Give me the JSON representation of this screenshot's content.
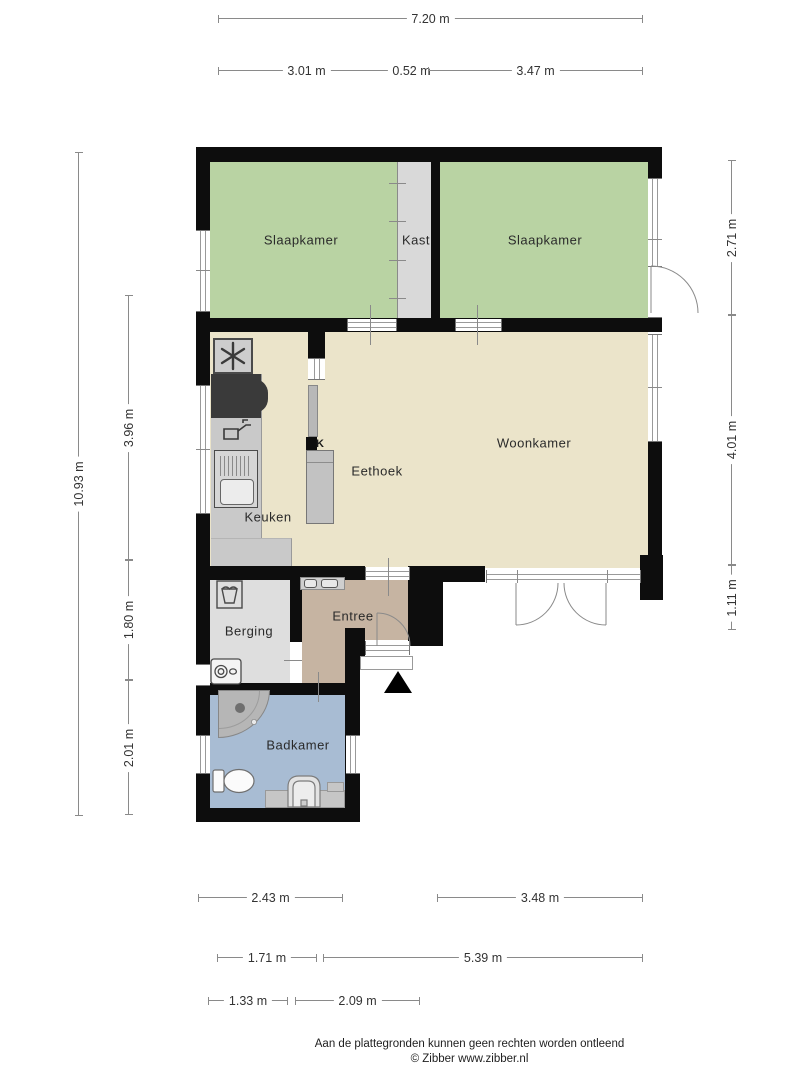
{
  "rooms": {
    "slaapkamer_left": "Slaapkamer",
    "kast": "Kast",
    "slaapkamer_right": "Slaapkamer",
    "woonkamer": "Woonkamer",
    "eethoek": "Eethoek",
    "keuken": "Keuken",
    "kast_small": "K",
    "berging": "Berging",
    "entree": "Entree",
    "badkamer": "Badkamer"
  },
  "dimensions": {
    "top_total": "7.20 m",
    "top_segments": [
      "3.01 m",
      "0.52 m",
      "3.47 m"
    ],
    "left_total": "10.93 m",
    "left_segments": [
      "3.96 m",
      "1.80 m",
      "2.01 m"
    ],
    "right_segments": [
      "2.71 m",
      "4.01 m",
      "1.11 m"
    ],
    "bottom_row1": [
      "2.43 m",
      "3.48 m"
    ],
    "bottom_row2": [
      "1.71 m",
      "5.39 m"
    ],
    "bottom_row3": [
      "1.33 m",
      "2.09 m"
    ]
  },
  "footer": {
    "disclaimer": "Aan de plattegronden kunnen geen rechten worden ontleend",
    "copyright": "© Zibber www.zibber.nl"
  },
  "colors": {
    "wall": "#0d0d0d",
    "bedroom_green": "#b9d3a3",
    "living_cream": "#ebe4ca",
    "closet_gray": "#d9d9d9",
    "storage_gray": "#dedede",
    "hall_tan": "#c6b4a2",
    "bathroom_blue": "#a8bcd3",
    "counter_gray": "#c9c9c9",
    "appliance_dark": "#3a3a3a",
    "dimension_line": "#8a8a8a"
  },
  "fixtures": [
    "extractor-hob",
    "stove",
    "faucet",
    "sink-unit",
    "closet-shelves",
    "laundry-basket",
    "washing-machine",
    "shower",
    "toilet",
    "washbasin",
    "entrance-arrow",
    "front-door",
    "bedroom-door",
    "french-doors"
  ]
}
